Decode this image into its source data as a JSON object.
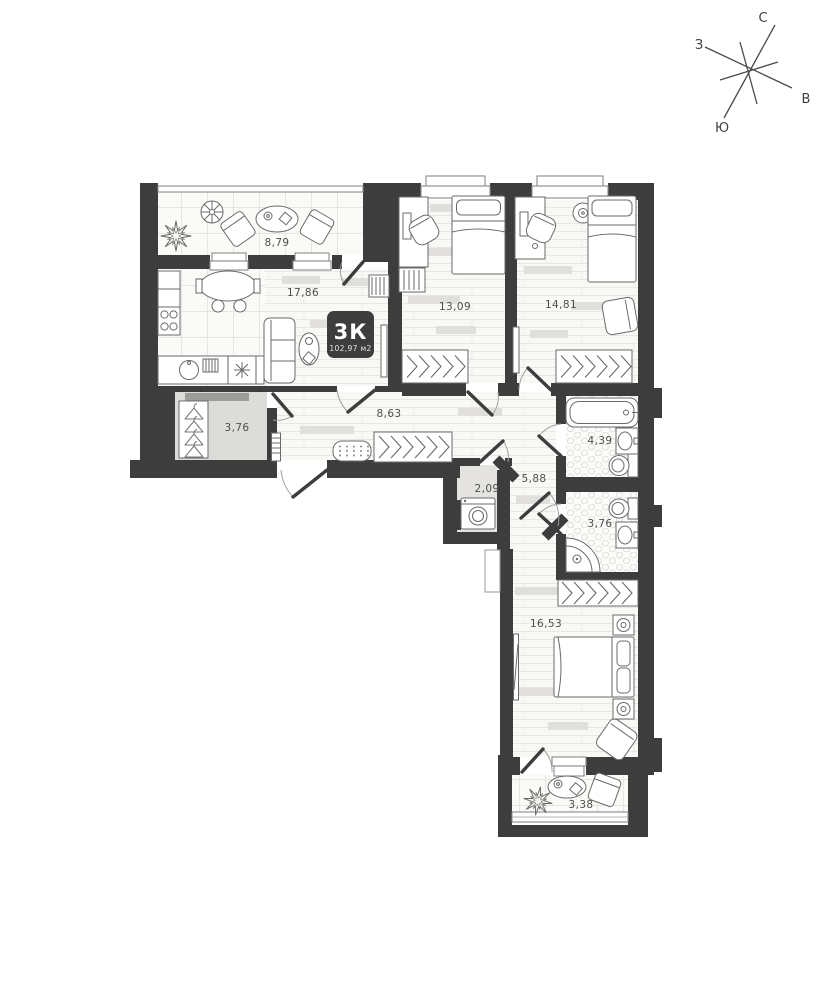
{
  "badge": {
    "type": "3К",
    "area": "102,97 м2"
  },
  "compass": {
    "north": "С",
    "east": "В",
    "south": "Ю",
    "west": "З"
  },
  "rooms": [
    {
      "id": "loggia-top",
      "area": "8,79"
    },
    {
      "id": "kitchen-living",
      "area": "17,86"
    },
    {
      "id": "bedroom-1",
      "area": "13,09"
    },
    {
      "id": "bedroom-2",
      "area": "14,81"
    },
    {
      "id": "wardrobe-room",
      "area": "3,76"
    },
    {
      "id": "hallway",
      "area": "8,63"
    },
    {
      "id": "inner-hall",
      "area": "5,88"
    },
    {
      "id": "laundry",
      "area": "2,09"
    },
    {
      "id": "bathroom",
      "area": "4,39"
    },
    {
      "id": "wc",
      "area": "3,76"
    },
    {
      "id": "bedroom-3",
      "area": "16,53"
    },
    {
      "id": "loggia-bottom",
      "area": "3,38"
    }
  ],
  "colors": {
    "wall": "#3d3d3d",
    "floor": "#f8f8f5",
    "badge_bg": "#3d3d3d",
    "badge_text": "#ffffff",
    "label_text": "#4f4f4f"
  }
}
